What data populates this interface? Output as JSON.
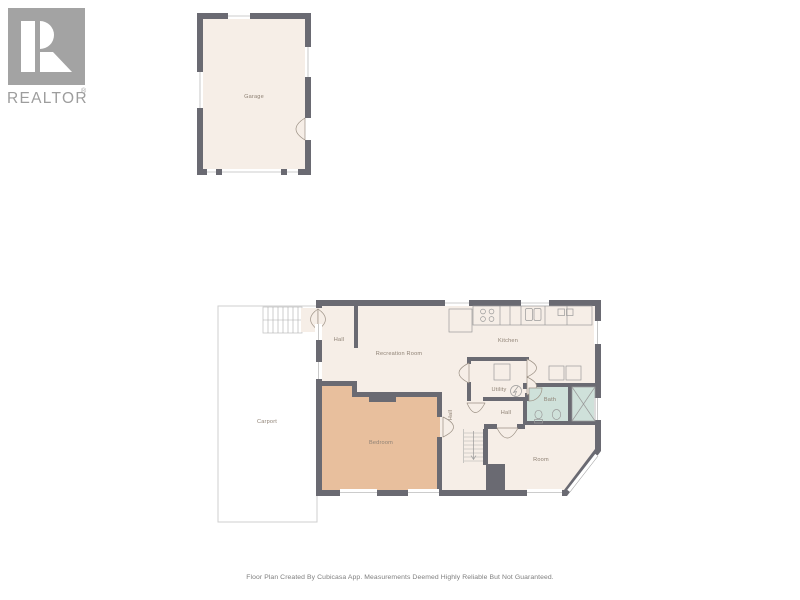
{
  "branding": {
    "logo_text": "REALTOR",
    "registered_mark": "®"
  },
  "rooms": {
    "garage": "Garage",
    "hall_entry": "Hall",
    "recreation_room": "Recreation Room",
    "kitchen": "Kitchen",
    "utility": "Utility",
    "bath": "Bath",
    "hall_center": "Hall",
    "hall_corridor": "Hall",
    "room": "Room",
    "bedroom": "Bedroom",
    "carport": "Carport"
  },
  "footer": {
    "disclaimer": "Floor Plan Created By Cubicasa App. Measurements Deemed Highly Reliable But Not Guaranteed."
  },
  "colors": {
    "wall": "#6a6a72",
    "floor": "#f6eee7",
    "bedroom_floor": "#e8bf9d",
    "bath_floor": "#cfe1da",
    "carport_border": "#cfcfcf",
    "label_text": "#8e8174",
    "logo_gray": "#9d9d9d"
  },
  "icons": {
    "fixtures": [
      "fridge-icon",
      "stove-icon",
      "sink-icon",
      "counter",
      "washer-icon",
      "water-heater-icon",
      "toilet-icon",
      "washbasin-icon",
      "wardrobe-icon",
      "stairs-icon",
      "door-arc-icon",
      "window-icon"
    ]
  }
}
